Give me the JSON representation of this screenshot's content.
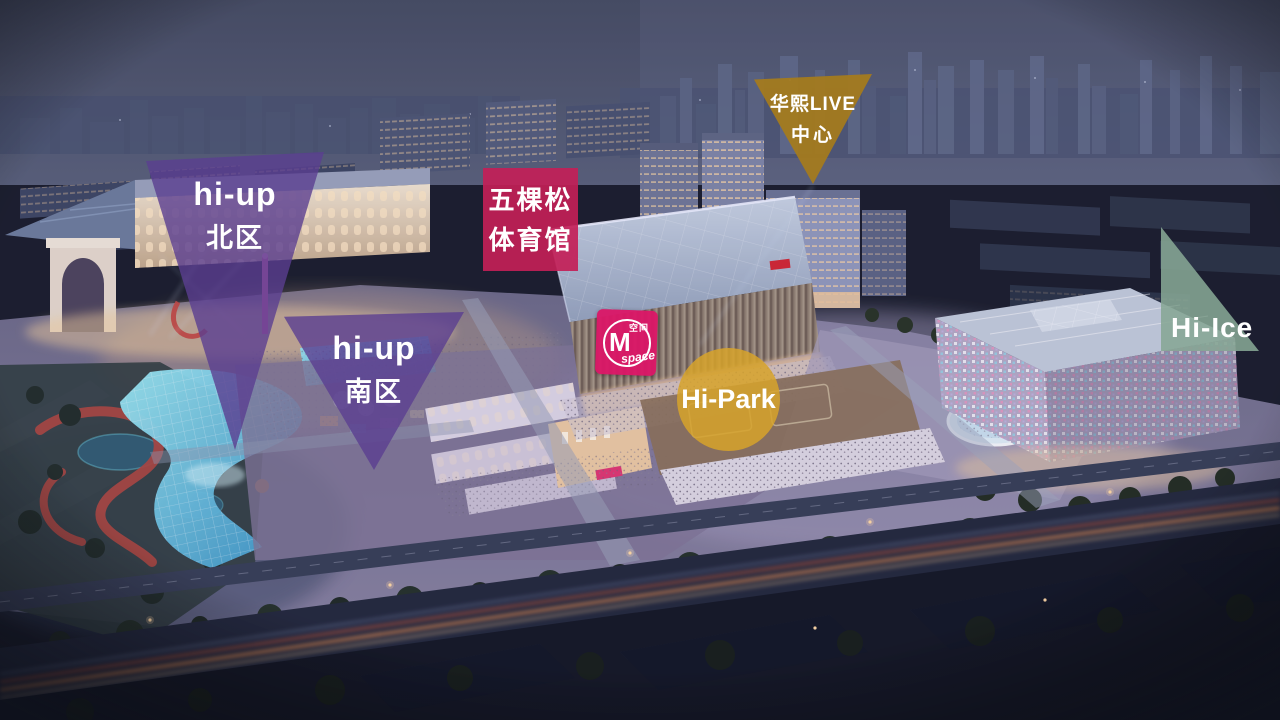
{
  "markers": {
    "hiup_north": {
      "brand": "hi-up",
      "area": "北区",
      "shape": "triangle-down",
      "color": "#5b3e91"
    },
    "hiup_south": {
      "brand": "hi-up",
      "area": "南区",
      "shape": "triangle-down",
      "color": "#5b3e91"
    },
    "stadium_label": {
      "line1": "五棵松",
      "line2": "体育馆",
      "shape": "rectangle",
      "color": "#c32057"
    },
    "huaxi_live_center": {
      "line1": "华熙LIVE",
      "line2": "中心",
      "shape": "triangle-down",
      "color": "#a57b1e"
    },
    "m_space": {
      "initial": "M",
      "cn": "空间",
      "en": "space",
      "shape": "badge",
      "color": "#da1767"
    },
    "hi_park": {
      "label": "Hi-Park",
      "shape": "circle",
      "color": "#d7a32b"
    },
    "hi_ice": {
      "label": "Hi-Ice",
      "shape": "triangle-right",
      "color": "#86a795"
    }
  }
}
